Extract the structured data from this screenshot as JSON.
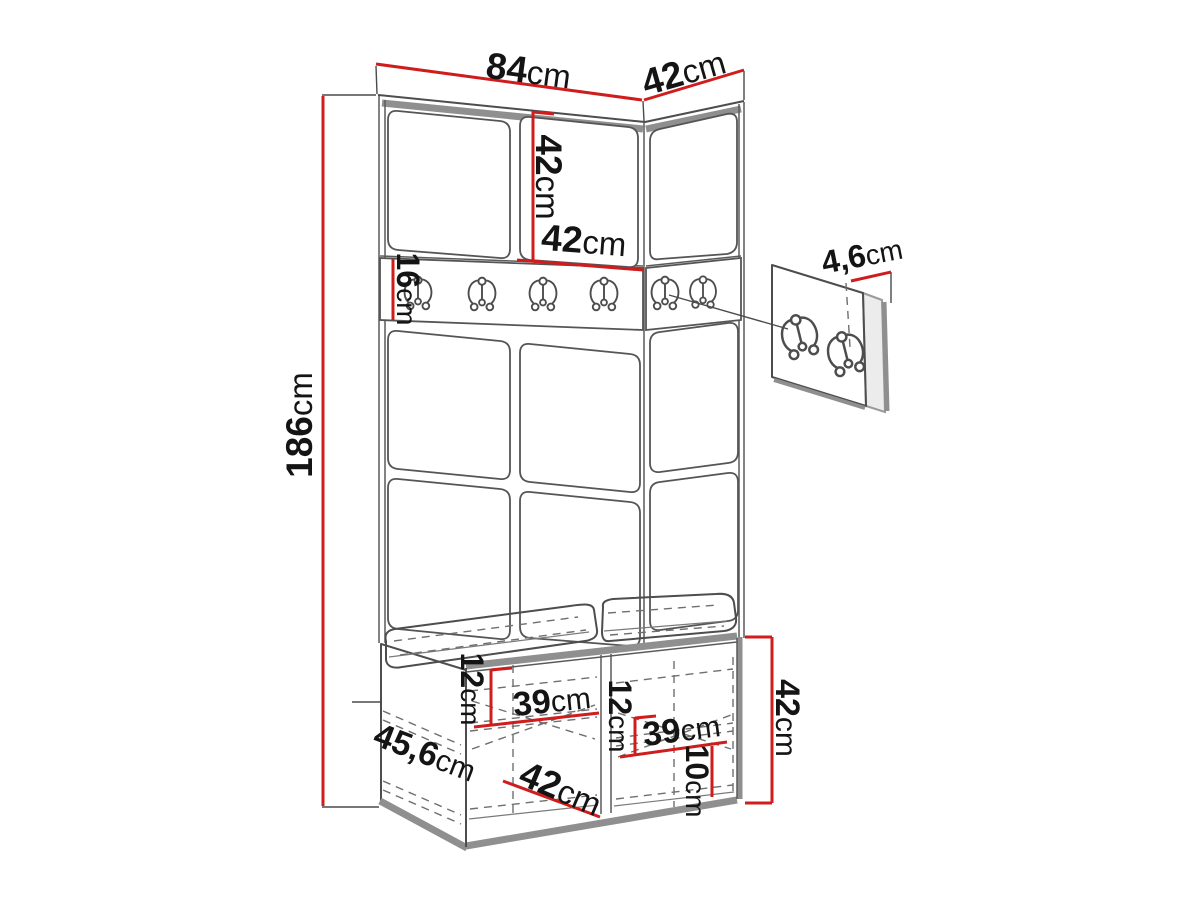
{
  "page": {
    "background": "#ffffff",
    "type": "furniture-dimension-diagram"
  },
  "dims": {
    "front_width": {
      "value": "84",
      "unit": "cm"
    },
    "side_width": {
      "value": "42",
      "unit": "cm"
    },
    "door_height": {
      "value": "42",
      "unit": "cm"
    },
    "door_width": {
      "value": "42",
      "unit": "cm"
    },
    "rail_height": {
      "value": "16",
      "unit": "cm"
    },
    "total_height": {
      "value": "186",
      "unit": "cm"
    },
    "panel_thickness": {
      "value": "4,6",
      "unit": "cm"
    },
    "bench_left_inner_height": {
      "value": "12",
      "unit": "cm"
    },
    "bench_left_inner_width": {
      "value": "39",
      "unit": "cm"
    },
    "bench_depth": {
      "value": "45,6",
      "unit": "cm"
    },
    "bench_front_width": {
      "value": "42",
      "unit": "cm"
    },
    "bench_right_inner_height": {
      "value": "12",
      "unit": "cm"
    },
    "bench_right_inner_width": {
      "value": "39",
      "unit": "cm"
    },
    "bench_plinth_height": {
      "value": "10",
      "unit": "cm"
    },
    "bench_height": {
      "value": "42",
      "unit": "cm"
    }
  },
  "icons": {
    "coat_hook_rail_count": 6,
    "coat_hook_panel_count": 2
  },
  "colors": {
    "dimension_line": "#cf1d1d",
    "outline": "#4d4d4d",
    "edge_thick": "#8f8f8f",
    "label_text": "#141414"
  }
}
